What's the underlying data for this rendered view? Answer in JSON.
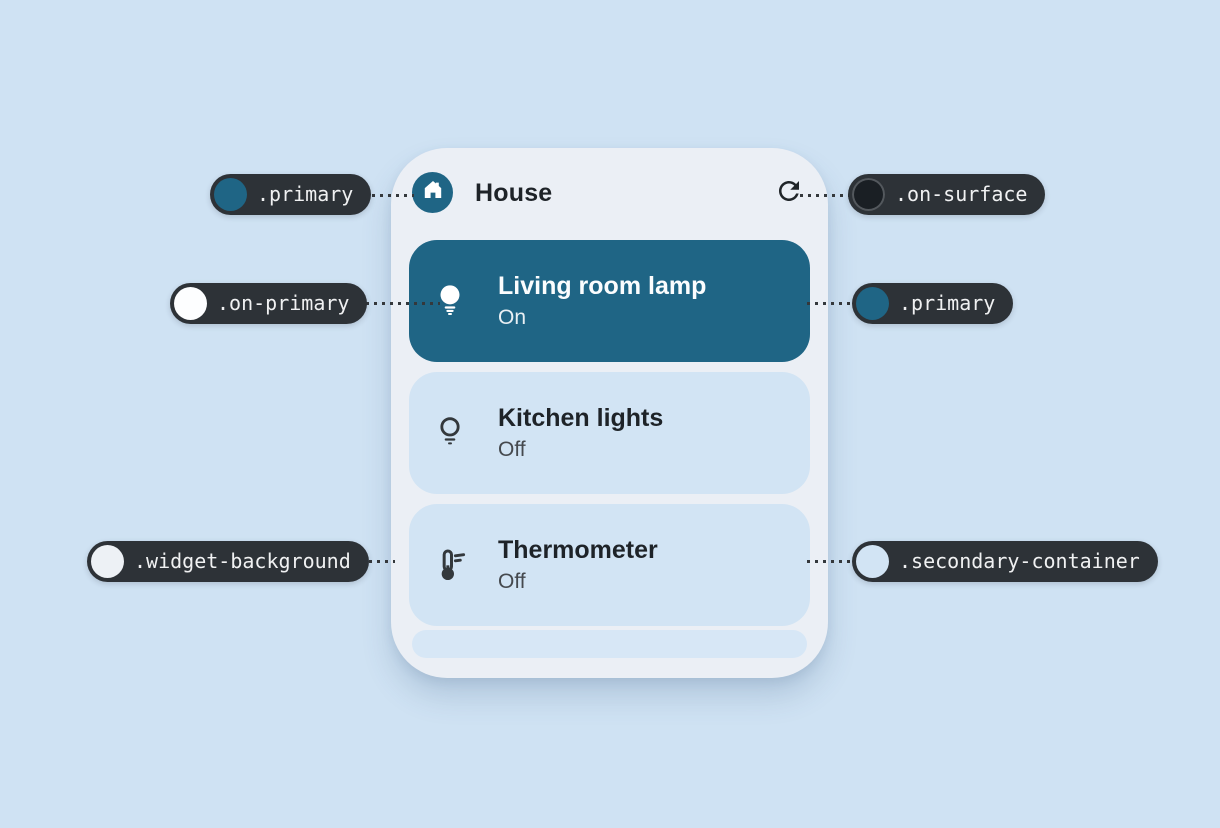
{
  "colors": {
    "page_background": "#cfe2f3",
    "widget_background": "#ebeff5",
    "primary": "#1f6585",
    "on_primary": "#fdfeff",
    "on_surface": "#1a1f24",
    "on_surface_ring": "#53585d",
    "secondary_container": "#d2e4f4",
    "annotation_pill": "#2d3237",
    "annotation_text": "#f0f1f2",
    "title_text": "#1e2328",
    "subtitle_text": "#45494e",
    "dotted_line": "#34383c"
  },
  "widget": {
    "header": {
      "title": "House",
      "leading_icon": "home-icon",
      "action_icon": "refresh-icon"
    },
    "devices": [
      {
        "name": "Living room lamp",
        "status": "On",
        "icon": "lightbulb-filled-icon",
        "active": true
      },
      {
        "name": "Kitchen lights",
        "status": "Off",
        "icon": "lightbulb-outline-icon",
        "active": false
      },
      {
        "name": "Thermometer",
        "status": "Off",
        "icon": "thermometer-icon",
        "active": false
      }
    ]
  },
  "annotations": [
    {
      "token": ".primary",
      "swatch": "#1f6585",
      "ring": null,
      "side": "left",
      "row": "top"
    },
    {
      "token": ".on-surface",
      "swatch": "#1a1f24",
      "ring": "#53585d",
      "side": "right",
      "row": "top"
    },
    {
      "token": ".on-primary",
      "swatch": "#fdfeff",
      "ring": null,
      "side": "left",
      "row": "middle"
    },
    {
      "token": ".primary",
      "swatch": "#1f6585",
      "ring": null,
      "side": "right",
      "row": "middle"
    },
    {
      "token": ".widget-background",
      "swatch": "#edf1f5",
      "ring": null,
      "side": "left",
      "row": "bottom"
    },
    {
      "token": ".secondary-container",
      "swatch": "#d2e4f4",
      "ring": null,
      "side": "right",
      "row": "bottom"
    }
  ]
}
